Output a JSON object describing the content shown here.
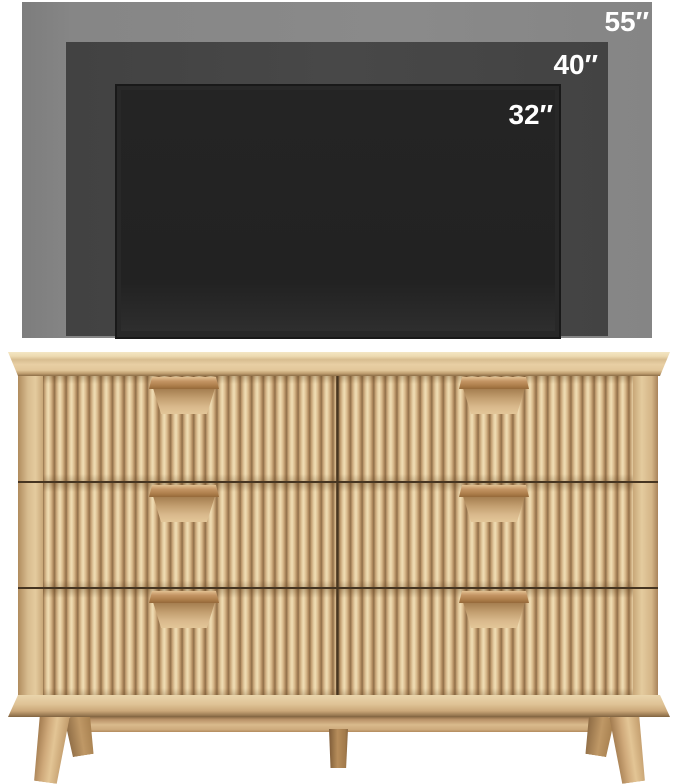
{
  "scene": {
    "kind": "furniture-product-size-comparison",
    "background_color": "#ffffff"
  },
  "tv_comparison": {
    "label_color": "#ffffff",
    "sizes": [
      {
        "label": "55″",
        "fill": "#858585"
      },
      {
        "label": "40″",
        "fill": "#474747"
      },
      {
        "label": "32″",
        "fill": "#282828"
      }
    ]
  },
  "dresser": {
    "style": "fluted-reeded-oak-double-dresser",
    "rows": 3,
    "columns": 2,
    "drawer_count": 6,
    "colors": {
      "wood_base": "#d7b98d",
      "wood_light": "#f0ddb4",
      "wood_dark": "#8f6f49",
      "handle": "#b68850",
      "divider_line": "#463521",
      "leg": "#cfa97a"
    },
    "drawers": [
      {
        "id": "top-left"
      },
      {
        "id": "top-right"
      },
      {
        "id": "middle-left"
      },
      {
        "id": "middle-right"
      },
      {
        "id": "bottom-left"
      },
      {
        "id": "bottom-right"
      }
    ],
    "legs": [
      "front-left",
      "rear-left",
      "middle",
      "rear-right",
      "front-right"
    ]
  }
}
